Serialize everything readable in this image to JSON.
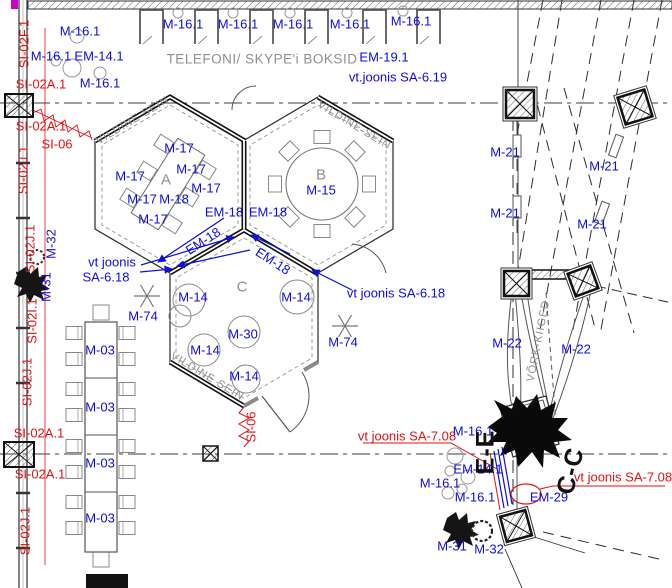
{
  "codes": {
    "m03": "M-03",
    "m14": "M-14",
    "m15": "M-15",
    "m16_1": "M-16.1",
    "m17": "M-17",
    "m18": "M-18",
    "m21": "M-21",
    "m22": "M-22",
    "m30": "M-30",
    "m31": "M-31",
    "m32": "M-32",
    "m74": "M-74",
    "em14_1": "EM-14.1",
    "em18": "EM-18",
    "em19_1": "EM-19.1",
    "em29": "EM-29",
    "si02a_1": "SI-02A.1",
    "si02f_1": "SI-02F.1",
    "si02i_1": "SI-02I.1",
    "si02j_1": "SI-02J.1",
    "si06": "SI-06"
  },
  "texts": {
    "booths_caption": "TELEFONI/ SKYPE'i BOKSID",
    "felt_wall": "VILDINE SEIN",
    "net_swings": "VÕRK-KIIGED",
    "zone_a": "A",
    "zone_b": "B",
    "zone_c": "C",
    "section_ee": "E-E",
    "section_cc": "C-C"
  },
  "notes": {
    "see_drawing_sa618_line1": "vt joonis",
    "see_drawing_sa618_line2": "SA-6.18",
    "see_drawing_sa618": "vt joonis SA-6.18",
    "see_drawing_sa619": "vt.joonis SA-6.19",
    "see_drawing_sa708": "vt joonis SA-7.08"
  },
  "colors": {
    "label_blue": "#0d0de0",
    "label_red": "#e31212",
    "annotation_gray": "#8f8f8f",
    "line_black": "#1a1a1a",
    "accent_magenta": "#cc00cc"
  }
}
